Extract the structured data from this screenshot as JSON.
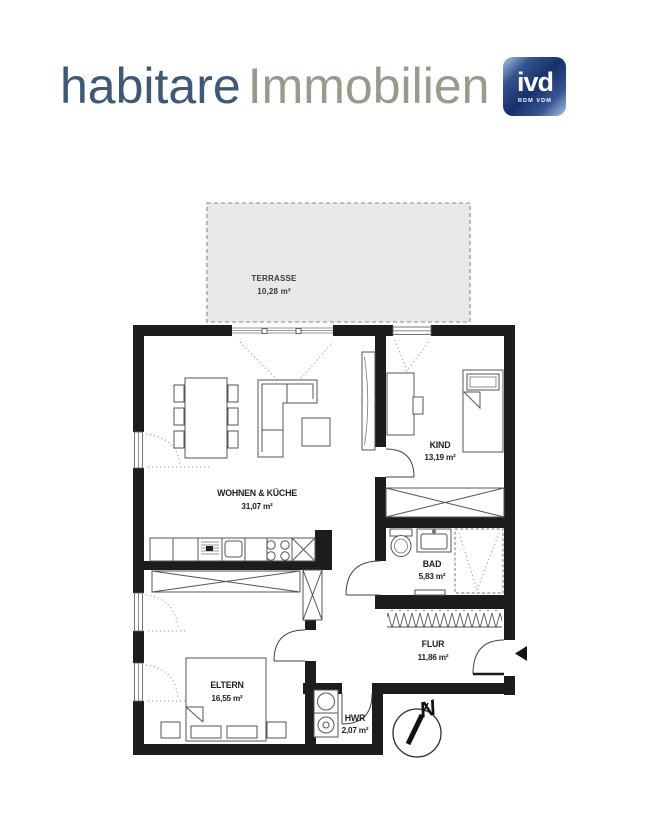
{
  "logo": {
    "brand": "habitare",
    "suffix": "Immobilien",
    "badge": {
      "text": "ivd",
      "subtext": "RDM VDM"
    },
    "colors": {
      "brand": "#3d5977",
      "suffix": "#9a9a8b",
      "badge_bg": "#16306b",
      "badge_accent": "#a9c6e4",
      "badge_fg": "#ffffff"
    }
  },
  "floorplan": {
    "colors": {
      "wall": "#1c1c1c",
      "furniture": "#555555",
      "terrace_fill": "#e9e9e9",
      "label": "#1f1f1f"
    },
    "terrace": {
      "name": "TERRASSE",
      "area": "10,28 m²"
    },
    "rooms": {
      "wohnen": {
        "name": "WOHNEN & KÜCHE",
        "area": "31,07 m²"
      },
      "kind": {
        "name": "KIND",
        "area": "13,19 m²"
      },
      "bad": {
        "name": "BAD",
        "area": "5,83 m²"
      },
      "flur": {
        "name": "FLUR",
        "area": "11,86 m²"
      },
      "eltern": {
        "name": "ELTERN",
        "area": "16,55 m²"
      },
      "hwr": {
        "name": "HWR",
        "area": "2,07 m²"
      }
    },
    "compass": {
      "north_label": "N"
    }
  }
}
